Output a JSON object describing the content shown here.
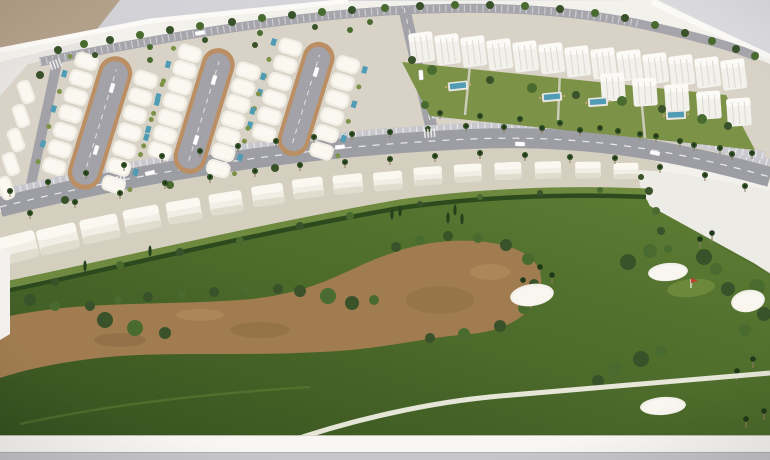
{
  "scene": {
    "medium": "photograph",
    "subject": "Architectural scale model (maquette) of a golf resort residential masterplan",
    "setting": "White model board photographed at an angle on a grey table, beige wall visible top-left",
    "inventory": {
      "cul_de_sac_streets": 3,
      "villa_clusters": "rows of white barrel-roof villas around three loop streets",
      "golf_front_villas": 16,
      "apartment_blocks": 18,
      "communal_pools": 4,
      "golf_bunkers": 4,
      "golf_flags": 1,
      "sand_waste_areas": 1,
      "cart_paths": 1,
      "empty_plot": 1,
      "palm_lined_boulevard": 1
    }
  },
  "palette": {
    "backdrop": "#c6c5ca",
    "backdrop_light": "#dcdbe0",
    "wall_tan": "#b3a08a",
    "board_white": "#f3f1ec",
    "board_edge": "#fbfaf7",
    "floor_gray": "#c6c5ca",
    "ground_pale": "#d8d3c6",
    "ground_warm": "#d5cfc0",
    "grass_dark": "#3c5822",
    "grass_light": "#5f7e34",
    "garden": "#7c9247",
    "waste_brown": "#a07c50",
    "waste_dark": "#7d5f3c",
    "waste_light": "#b78f5e",
    "road": "#a2a2a8",
    "parking": "#c7c7cd",
    "curb_tan": "#bb8f63",
    "villa": "#f1eee5",
    "villa_roof": "#faf8f1",
    "villa_shadow": "#ddd8ca",
    "apartment": "#f2f1eb",
    "apartment_cap": "#fbfaf6",
    "hedge": "#2c4a1d",
    "lawn": "#6d8a3e",
    "tree_dark": "#39522a",
    "tree_mid": "#4a6b30",
    "cypress": "#23401c",
    "pool": "#4f9cb4",
    "bunker": "#f1efe7",
    "path": "#efede2",
    "plot_white": "#edebe6",
    "flag_red": "#c63b2a",
    "car_white": "#fdfdfd",
    "trunk": "#8a7a5e"
  },
  "model": {
    "loop_streets": [
      {
        "cx": 100,
        "cy": 123,
        "rot": -73,
        "len": 128,
        "w": 26,
        "villas": 7
      },
      {
        "cx": 204,
        "cy": 111,
        "rot": -73,
        "len": 120,
        "w": 25,
        "villas": 7
      },
      {
        "cx": 306,
        "cy": 99,
        "rot": -73,
        "len": 108,
        "w": 24,
        "villas": 6
      }
    ],
    "left_villas": [
      [
        26,
        92
      ],
      [
        21,
        116
      ],
      [
        16,
        140
      ],
      [
        11,
        164
      ],
      [
        6,
        188
      ]
    ],
    "golf_villas": [
      [
        16,
        248,
        -14,
        1.25
      ],
      [
        58,
        239,
        -13,
        1.18
      ],
      [
        100,
        229,
        -12,
        1.12
      ],
      [
        142,
        219,
        -11,
        1.06
      ],
      [
        184,
        211,
        -10,
        1.01
      ],
      [
        226,
        203,
        -9,
        0.97
      ],
      [
        268,
        195,
        -8,
        0.93
      ],
      [
        308,
        188,
        -7,
        0.9
      ],
      [
        348,
        184,
        -6,
        0.87
      ],
      [
        388,
        181,
        -5,
        0.85
      ],
      [
        428,
        176,
        -4,
        0.83
      ],
      [
        468,
        173,
        -3,
        0.81
      ],
      [
        508,
        171,
        -2,
        0.79
      ],
      [
        548,
        170,
        -2,
        0.77
      ],
      [
        588,
        170,
        -1,
        0.75
      ],
      [
        626,
        171,
        -1,
        0.73
      ]
    ],
    "apartments_row1": [
      [
        408,
        34
      ],
      [
        434,
        36
      ],
      [
        460,
        38
      ],
      [
        486,
        41
      ],
      [
        512,
        43
      ],
      [
        538,
        45
      ],
      [
        564,
        48
      ],
      [
        590,
        50
      ],
      [
        616,
        52
      ],
      [
        642,
        55
      ],
      [
        668,
        57
      ],
      [
        694,
        59
      ],
      [
        720,
        61
      ]
    ],
    "apartments_row2": [
      [
        600,
        74
      ],
      [
        632,
        79
      ],
      [
        664,
        85
      ],
      [
        696,
        92
      ],
      [
        726,
        99
      ]
    ],
    "apartment_pools": [
      [
        458,
        86,
        -6
      ],
      [
        552,
        97,
        -5
      ],
      [
        598,
        102,
        -4
      ],
      [
        676,
        115,
        -3
      ]
    ],
    "back_trees": [
      [
        58,
        50,
        4
      ],
      [
        84,
        44,
        4
      ],
      [
        110,
        40,
        4
      ],
      [
        140,
        35,
        4
      ],
      [
        170,
        30,
        4
      ],
      [
        200,
        26,
        4
      ],
      [
        232,
        22,
        4
      ],
      [
        262,
        18,
        4
      ],
      [
        292,
        15,
        4
      ],
      [
        322,
        12,
        4
      ],
      [
        352,
        10,
        4
      ],
      [
        385,
        8,
        4
      ],
      [
        420,
        6,
        4
      ],
      [
        455,
        5,
        4
      ],
      [
        490,
        5,
        4
      ],
      [
        525,
        6,
        4
      ],
      [
        560,
        9,
        4
      ],
      [
        595,
        13,
        4
      ],
      [
        625,
        18,
        4
      ],
      [
        655,
        25,
        4
      ],
      [
        685,
        33,
        4
      ],
      [
        712,
        41,
        4
      ],
      [
        736,
        49,
        4
      ],
      [
        755,
        56,
        4
      ],
      [
        95,
        55,
        3
      ],
      [
        150,
        47,
        3
      ],
      [
        205,
        40,
        3
      ],
      [
        260,
        33,
        3
      ],
      [
        315,
        27,
        3
      ],
      [
        370,
        22,
        3
      ]
    ],
    "trees": [
      [
        90,
        306,
        5,
        0
      ],
      [
        118,
        300,
        4,
        1
      ],
      [
        148,
        297,
        5,
        0
      ],
      [
        182,
        295,
        4,
        1
      ],
      [
        214,
        292,
        5,
        0
      ],
      [
        246,
        290,
        4,
        1
      ],
      [
        278,
        289,
        5,
        0
      ],
      [
        30,
        300,
        6,
        0
      ],
      [
        55,
        306,
        5,
        1
      ],
      [
        105,
        320,
        8,
        0
      ],
      [
        135,
        328,
        8,
        1
      ],
      [
        165,
        333,
        6,
        0
      ],
      [
        300,
        291,
        6,
        0
      ],
      [
        328,
        296,
        8,
        1
      ],
      [
        352,
        303,
        7,
        0
      ],
      [
        374,
        300,
        5,
        1
      ],
      [
        396,
        247,
        5,
        0
      ],
      [
        420,
        240,
        5,
        1
      ],
      [
        448,
        236,
        5,
        0
      ],
      [
        478,
        238,
        5,
        1
      ],
      [
        506,
        245,
        6,
        0
      ],
      [
        528,
        259,
        6,
        1
      ],
      [
        534,
        284,
        5,
        0
      ],
      [
        524,
        308,
        6,
        1
      ],
      [
        500,
        326,
        6,
        0
      ],
      [
        464,
        334,
        6,
        1
      ],
      [
        430,
        338,
        5,
        0
      ],
      [
        628,
        262,
        8,
        0
      ],
      [
        650,
        251,
        7,
        1
      ],
      [
        704,
        257,
        8,
        0
      ],
      [
        716,
        269,
        6,
        1
      ],
      [
        728,
        289,
        7,
        0
      ],
      [
        757,
        287,
        8,
        1
      ],
      [
        764,
        314,
        7,
        0
      ],
      [
        745,
        330,
        6,
        1
      ],
      [
        598,
        381,
        6,
        0
      ],
      [
        615,
        369,
        7,
        1
      ],
      [
        641,
        359,
        8,
        0
      ],
      [
        661,
        351,
        6,
        1
      ],
      [
        55,
        282,
        4,
        0
      ],
      [
        120,
        265,
        4,
        1
      ],
      [
        180,
        252,
        4,
        0
      ],
      [
        240,
        241,
        4,
        1
      ],
      [
        300,
        226,
        4,
        0
      ],
      [
        350,
        216,
        4,
        1
      ],
      [
        420,
        204,
        3,
        0
      ],
      [
        480,
        197,
        3,
        1
      ],
      [
        540,
        193,
        3,
        0
      ],
      [
        600,
        190,
        3,
        1
      ],
      [
        432,
        70,
        5,
        1
      ],
      [
        490,
        80,
        4,
        0
      ],
      [
        532,
        88,
        5,
        1
      ],
      [
        576,
        95,
        4,
        0
      ],
      [
        622,
        101,
        5,
        1
      ],
      [
        662,
        109,
        4,
        0
      ],
      [
        702,
        119,
        5,
        1
      ],
      [
        728,
        126,
        4,
        0
      ],
      [
        649,
        191,
        4,
        0
      ],
      [
        656,
        211,
        4,
        1
      ],
      [
        661,
        231,
        4,
        0
      ],
      [
        668,
        249,
        4,
        1
      ],
      [
        641,
        177,
        3,
        0
      ],
      [
        40,
        75,
        4,
        0
      ],
      [
        150,
        60,
        3,
        1
      ],
      [
        255,
        45,
        3,
        0
      ],
      [
        350,
        30,
        3,
        1
      ],
      [
        65,
        200,
        4,
        0
      ],
      [
        170,
        185,
        4,
        1
      ],
      [
        275,
        168,
        4,
        0
      ],
      [
        412,
        60,
        4,
        0
      ],
      [
        425,
        105,
        4,
        1
      ]
    ],
    "cypresses": [
      [
        455,
        210
      ],
      [
        462,
        219
      ],
      [
        448,
        218
      ],
      [
        85,
        266
      ],
      [
        150,
        251
      ],
      [
        392,
        214
      ],
      [
        400,
        211
      ]
    ],
    "palms": [
      [
        10,
        191
      ],
      [
        48,
        182
      ],
      [
        86,
        173
      ],
      [
        124,
        165
      ],
      [
        162,
        156
      ],
      [
        200,
        151
      ],
      [
        238,
        146
      ],
      [
        276,
        141
      ],
      [
        314,
        137
      ],
      [
        352,
        134
      ],
      [
        390,
        132
      ],
      [
        428,
        129
      ],
      [
        466,
        126
      ],
      [
        504,
        127
      ],
      [
        542,
        128
      ],
      [
        580,
        130
      ],
      [
        618,
        131
      ],
      [
        656,
        136
      ],
      [
        694,
        145
      ],
      [
        732,
        154
      ],
      [
        30,
        213
      ],
      [
        75,
        202
      ],
      [
        120,
        193
      ],
      [
        165,
        183
      ],
      [
        210,
        177
      ],
      [
        255,
        171
      ],
      [
        300,
        165
      ],
      [
        345,
        162
      ],
      [
        390,
        159
      ],
      [
        435,
        156
      ],
      [
        480,
        153
      ],
      [
        525,
        155
      ],
      [
        570,
        157
      ],
      [
        615,
        158
      ],
      [
        660,
        167
      ],
      [
        705,
        175
      ],
      [
        745,
        186
      ],
      [
        440,
        113
      ],
      [
        480,
        116
      ],
      [
        520,
        119
      ],
      [
        560,
        123
      ],
      [
        600,
        128
      ],
      [
        640,
        134
      ],
      [
        680,
        141
      ],
      [
        720,
        148
      ],
      [
        752,
        153
      ]
    ],
    "golf_palms": [
      [
        540,
        267
      ],
      [
        552,
        275
      ],
      [
        523,
        280
      ],
      [
        700,
        239
      ],
      [
        712,
        233
      ],
      [
        737,
        371
      ],
      [
        753,
        359
      ],
      [
        764,
        411
      ],
      [
        746,
        419
      ]
    ],
    "bunkers": [
      [
        532,
        295,
        22,
        11,
        -8
      ],
      [
        668,
        272,
        20,
        9,
        -5
      ],
      [
        748,
        301,
        17,
        11,
        -10
      ],
      [
        663,
        406,
        23,
        9,
        -4
      ]
    ],
    "cars": [
      [
        112,
        88,
        -73
      ],
      [
        96,
        150,
        -73
      ],
      [
        214,
        80,
        -73
      ],
      [
        196,
        140,
        -73
      ],
      [
        316,
        72,
        -73
      ],
      [
        150,
        173,
        -13
      ],
      [
        340,
        147,
        -6
      ],
      [
        520,
        144,
        2
      ],
      [
        655,
        153,
        11
      ],
      [
        200,
        33,
        -9
      ],
      [
        421,
        75,
        86
      ]
    ],
    "crosswalks": [
      [
        430,
        133,
        -5
      ],
      [
        120,
        180,
        -13
      ],
      [
        56,
        64,
        -20
      ]
    ]
  }
}
